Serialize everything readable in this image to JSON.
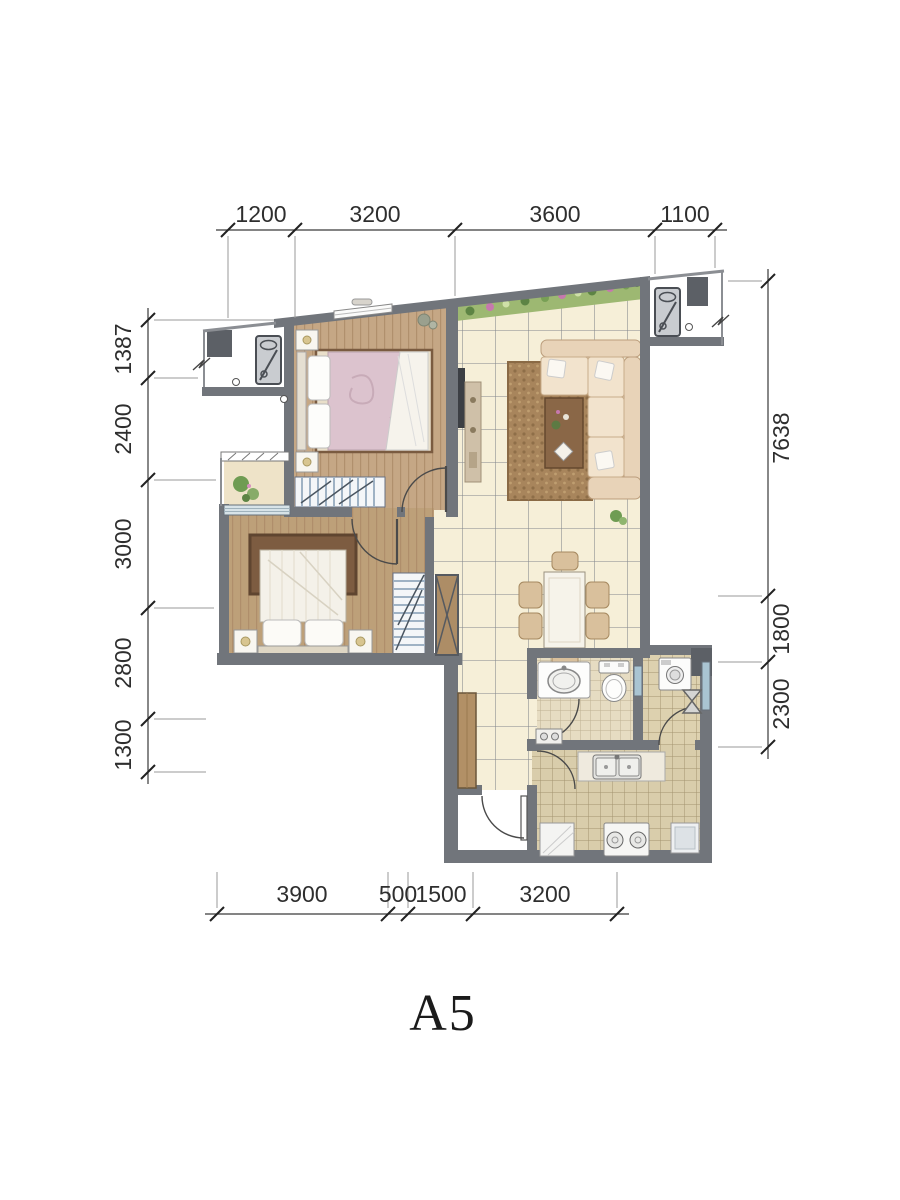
{
  "title": {
    "label": "A5"
  },
  "dimensions": {
    "top": [
      "1200",
      "3200",
      "3600",
      "1100"
    ],
    "left": [
      "1387",
      "2400",
      "3000",
      "2800",
      "1300"
    ],
    "right": [
      "7638",
      "1800",
      "2300"
    ],
    "bottom": [
      "3900",
      "500",
      "1500",
      "3200"
    ]
  },
  "legend_icons": [
    "double-bed-icon",
    "wardrobe-icon",
    "sofa-icon",
    "coffee-table-icon",
    "tv-icon",
    "tv-cabinet-icon",
    "dining-table-icon",
    "dining-chair-icon",
    "washbasin-icon",
    "toilet-icon",
    "washing-machine-icon",
    "water-heater-icon",
    "kitchen-sink-icon",
    "gas-stove-icon",
    "air-conditioner-icon",
    "plant-icon",
    "flower-bed-icon",
    "shoe-cabinet-icon",
    "storage-cabinet-icon",
    "door-swing-icon",
    "window-icon",
    "break-line-icon"
  ],
  "colors": {
    "wall": "#71757b",
    "wall_dark": "#5c6066",
    "wood_floor": "#c5a785",
    "tile_floor": "#f6efd8",
    "bath_tile": "#e6dcc2",
    "kitchen_tile": "#d9cdab",
    "rug_living": "#a8855c",
    "rug_bedroom": "#7d5c41",
    "sofa": "#eedbc2",
    "garden": "#9db872",
    "window_glass": "#a9c4d2",
    "dimension_text": "#2e2e2e"
  }
}
